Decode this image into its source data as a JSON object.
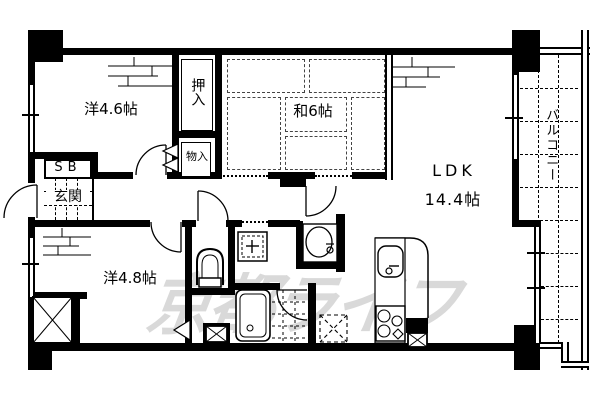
{
  "floorplan": {
    "background_color": "#ffffff",
    "line_color": "#000000",
    "watermark": {
      "text": "京都ライフ",
      "color": "#d9d9d9"
    },
    "rooms": {
      "western1": {
        "label": "洋4.6帖"
      },
      "japanese": {
        "label": "和6帖"
      },
      "ldk": {
        "label_line1": "LDK",
        "label_line2": "14.4帖"
      },
      "western2": {
        "label": "洋4.8帖"
      },
      "balcony": {
        "label": "バルコニー"
      },
      "oshiire": {
        "label": "押入"
      },
      "monoire": {
        "label": "物入"
      },
      "shoebox": {
        "label": "SB"
      },
      "genkan": {
        "label": "玄関"
      }
    },
    "fixtures": [
      "toilet",
      "bathtub",
      "washbasin",
      "washing-machine-pan",
      "kitchen-sink",
      "gas-stove",
      "underfloor-storage-hatch",
      "pipe-space-x",
      "door-swing-arc",
      "tatami-mats",
      "balcony-tiles"
    ]
  }
}
